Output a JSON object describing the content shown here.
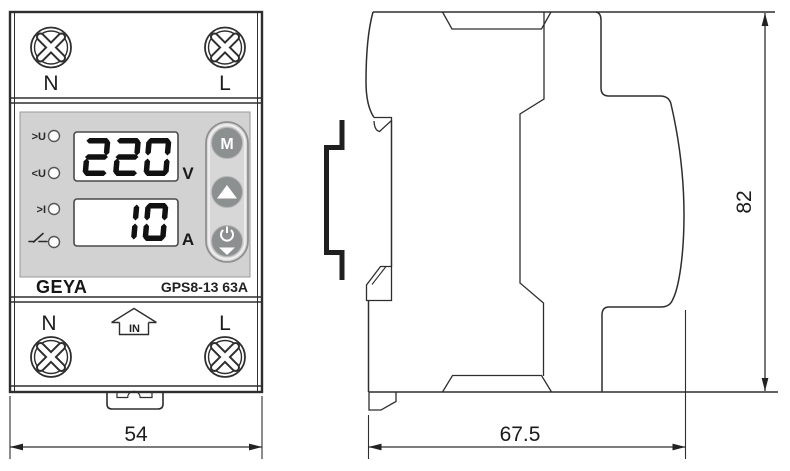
{
  "device": {
    "brand": "GEYA",
    "model": "GPS8-13 63A"
  },
  "front_view": {
    "top_terminals": {
      "left_label": "N",
      "right_label": "L"
    },
    "bottom_terminals": {
      "left_label": "N",
      "right_label": "L",
      "input_label": "IN"
    },
    "indicator_labels": {
      "over_voltage": ">U",
      "under_voltage": "<U",
      "over_current": ">I",
      "switch_icon": "open-contact-symbol"
    },
    "display": {
      "voltage_value": "220",
      "voltage_unit": "V",
      "current_value": "10",
      "current_unit": "A"
    },
    "buttons": {
      "mode_label": "M",
      "up_icon": "up-triangle",
      "power_icon": "power-symbol-with-down-triangle"
    }
  },
  "dimensions_mm": {
    "width": "54",
    "depth": "67.5",
    "height": "82"
  },
  "colors": {
    "panel_gray": "#d2d2d2",
    "pill_gray": "#d7d7d7",
    "button_gray": "#8d9090",
    "line": "#2e2e2e",
    "segment": "#111111"
  }
}
